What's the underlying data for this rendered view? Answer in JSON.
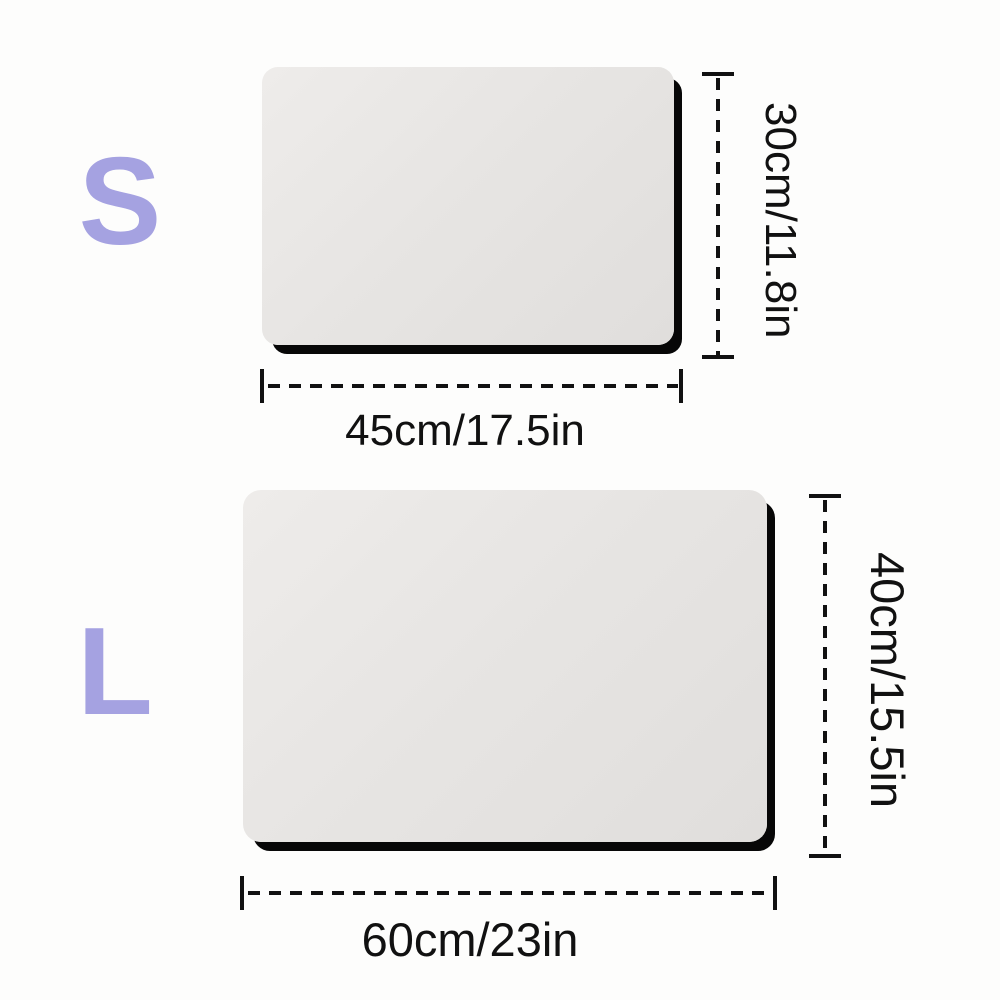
{
  "diagram_title": "mat-size-comparison",
  "colors": {
    "background": "#fdfdfc",
    "ink": "#111111",
    "accent": "#a5a2e1",
    "mat_surface": "#e6e4e2",
    "mat_underlay": "#070707"
  },
  "sizes": [
    {
      "label": "S",
      "width_label": "45cm/17.5in",
      "height_label": "30cm/11.8in"
    },
    {
      "label": "L",
      "width_label": "60cm/23in",
      "height_label": "40cm/15.5in"
    }
  ]
}
